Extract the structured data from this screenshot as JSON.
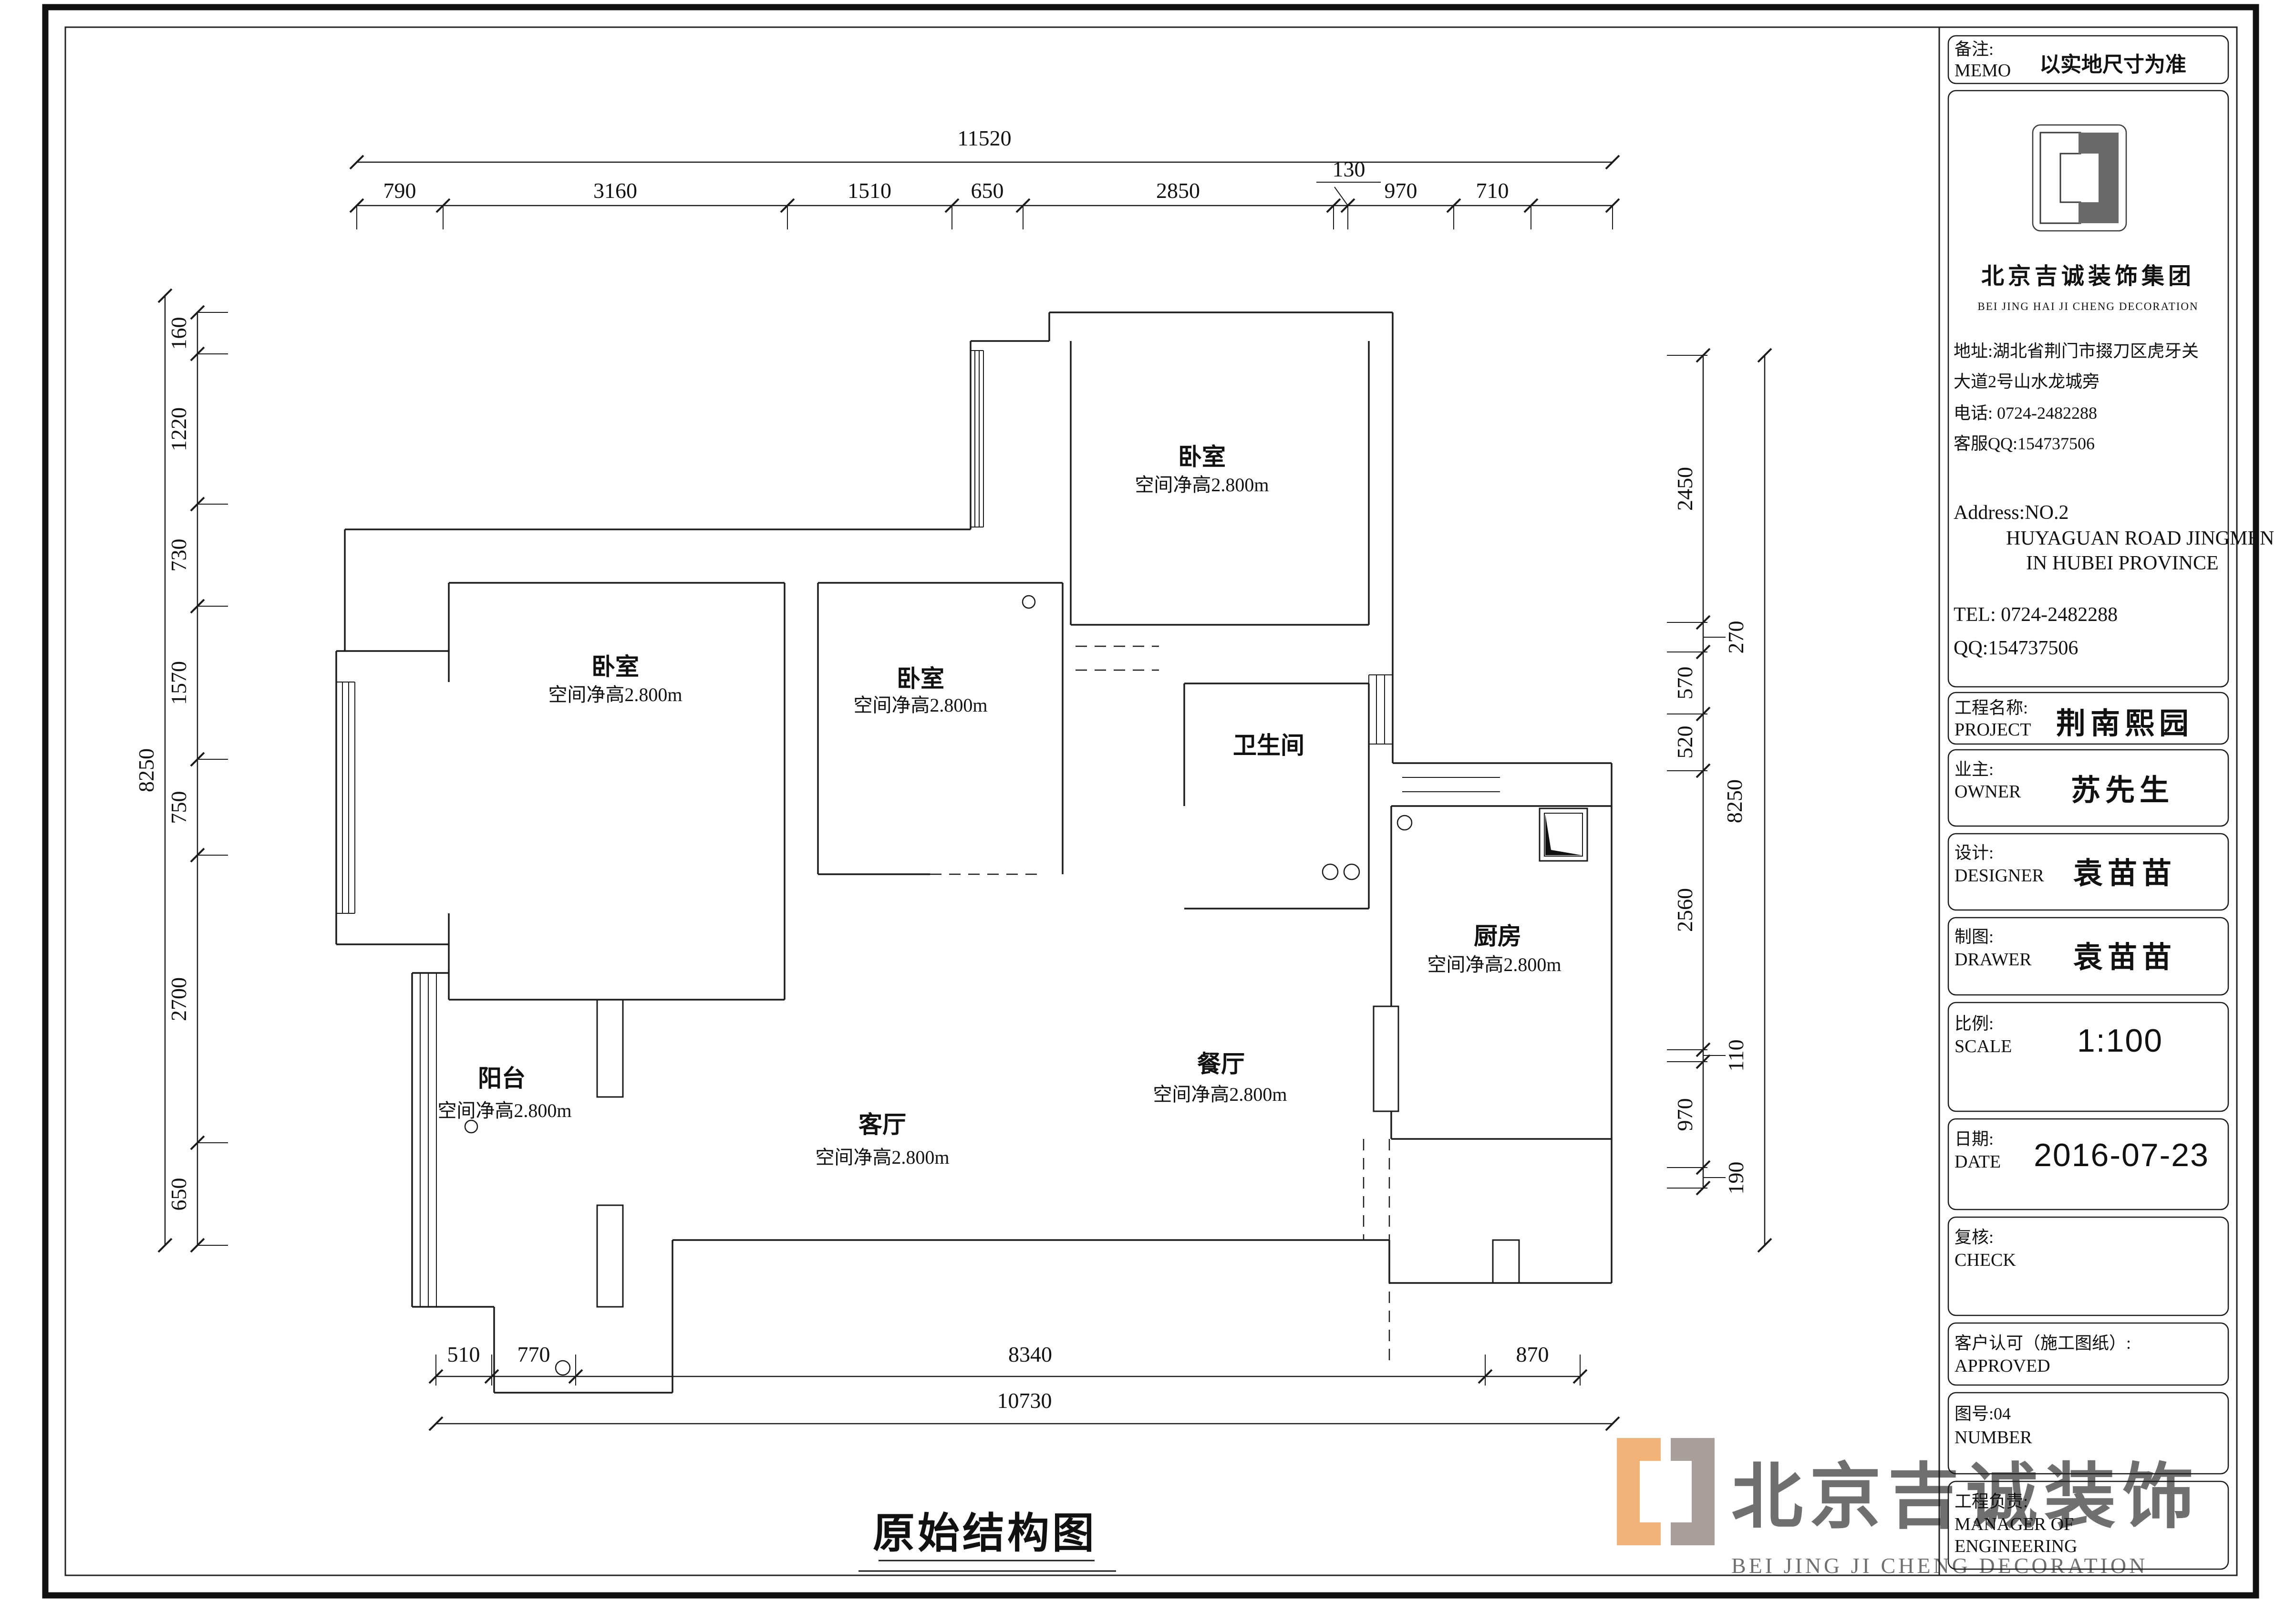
{
  "drawing_title": "原始结构图",
  "rooms": [
    {
      "name": "卧室",
      "height": "空间净高2.800m"
    },
    {
      "name": "卧室",
      "height": "空间净高2.800m"
    },
    {
      "name": "卧室",
      "height": "空间净高2.800m"
    },
    {
      "name": "卫生间"
    },
    {
      "name": "厨房",
      "height": "空间净高2.800m"
    },
    {
      "name": "阳台",
      "height": "空间净高2.800m"
    },
    {
      "name": "客厅",
      "height": "空间净高2.800m"
    },
    {
      "name": "餐厅",
      "height": "空间净高2.800m"
    }
  ],
  "dims": {
    "top_total": "11520",
    "top": [
      "790",
      "3160",
      "1510",
      "650",
      "2850",
      "130",
      "970",
      "710"
    ],
    "left_total": "8250",
    "left": [
      "160",
      "1220",
      "730",
      "1570",
      "750",
      "2700",
      "650"
    ],
    "right_total": "8250",
    "right": [
      "2450",
      "270",
      "570",
      "520",
      "2560",
      "110",
      "970",
      "190"
    ],
    "bottom": [
      "510",
      "770",
      "8340",
      "870"
    ],
    "bottom_total": "10730"
  },
  "titleblock": {
    "memo_label_cn": "备注:",
    "memo_label_en": "MEMO",
    "memo_value": "以实地尺寸为准",
    "company_cn": "北京吉诚装饰集团",
    "company_en": "BEI JING HAI JI CHENG DECORATION",
    "address_cn_1": "地址:湖北省荆门市掇刀区虎牙关",
    "address_cn_2": "大道2号山水龙城旁",
    "phone_cn": "电话: 0724-2482288",
    "qq_cn": "客服QQ:154737506",
    "address_en_1": "Address:NO.2",
    "address_en_2": "HUYAGUAN ROAD JINGMEN",
    "address_en_3": "IN HUBEI PROVINCE",
    "tel_en": "TEL: 0724-2482288",
    "qq_en": "QQ:154737506",
    "project_label_cn": "工程名称:",
    "project_label_en": "PROJECT",
    "project_value": "荆南熙园",
    "owner_label_cn": "业主:",
    "owner_label_en": "OWNER",
    "owner_value": "苏先生",
    "designer_label_cn": "设计:",
    "designer_label_en": "DESIGNER",
    "designer_value": "袁苗苗",
    "drawer_label_cn": "制图:",
    "drawer_label_en": "DRAWER",
    "drawer_value": "袁苗苗",
    "scale_label_cn": "比例:",
    "scale_label_en": "SCALE",
    "scale_value": "1:100",
    "date_label_cn": "日期:",
    "date_label_en": "DATE",
    "date_value": "2016-07-23",
    "check_label_cn": "复核:",
    "check_label_en": "CHECK",
    "approved_label_cn": "客户认可（施工图纸）:",
    "approved_label_en": "APPROVED",
    "number_label_cn": "图号:04",
    "number_label_en": "NUMBER",
    "engineering_label_cn": "工程负责:",
    "engineering_label_en_1": "MANAGER OF",
    "engineering_label_en_2": "ENGINEERING"
  },
  "watermark": {
    "text_cn": "北京吉诚装饰",
    "text_en": "BEI JING JI CHENG DECORATION",
    "accent_orange": "#e8821e",
    "accent_taupe": "#6f6159",
    "gray": "#cdc8c2"
  }
}
